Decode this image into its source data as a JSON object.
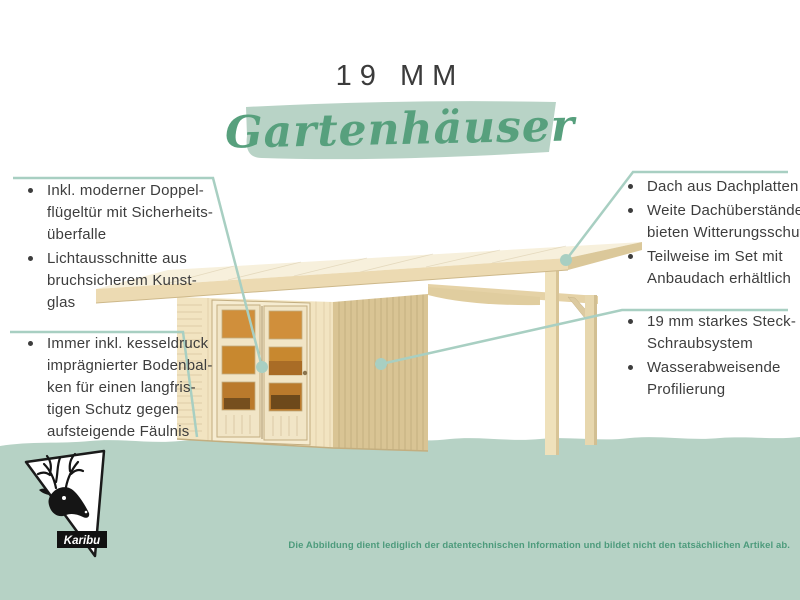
{
  "title": {
    "size_label": "19 MM",
    "script_title": "Gartenhäuser"
  },
  "callouts": {
    "left_top": {
      "items": [
        {
          "lines": [
            "Inkl. moderner Doppel-",
            "flügeltür mit Sicherheits-",
            "überfalle"
          ]
        },
        {
          "lines": [
            "Lichtausschnitte aus",
            "bruchsicherem Kunst-",
            "glas"
          ]
        }
      ]
    },
    "left_bottom": {
      "items": [
        {
          "lines": [
            "Immer inkl. kesseldruck",
            "imprägnierter Bodenbal-",
            "ken für einen langfris-",
            "tigen Schutz gegen",
            "aufsteigende Fäulnis"
          ]
        }
      ]
    },
    "right_top": {
      "items": [
        {
          "lines": [
            "Dach aus Dachplatten"
          ]
        },
        {
          "lines": [
            "Weite Dachüberstände",
            "bieten Witterungsschutz"
          ]
        },
        {
          "lines": [
            "Teilweise im Set mit",
            "Anbaudach erhältlich"
          ]
        }
      ]
    },
    "right_bottom": {
      "items": [
        {
          "lines": [
            "19 mm starkes Steck-",
            "Schraubsystem"
          ]
        },
        {
          "lines": [
            "Wasserabweisende",
            "Profilierung"
          ]
        }
      ]
    }
  },
  "footer": {
    "logo_text": "Karibu",
    "disclaimer": "Die Abbildung dient lediglich der datentechnischen Information und bildet nicht den tatsächlichen Artikel ab."
  },
  "colors": {
    "accent_green": "#57a07d",
    "band_green": "#b6d2c5",
    "callout_line": "#a8cfc2",
    "text_dark": "#3d3d3d",
    "disclaimer_green": "#4d9b7c",
    "wood_light": "#f2e4c1",
    "wood_dark": "#d9c494",
    "window_amber": "#c8882f"
  }
}
